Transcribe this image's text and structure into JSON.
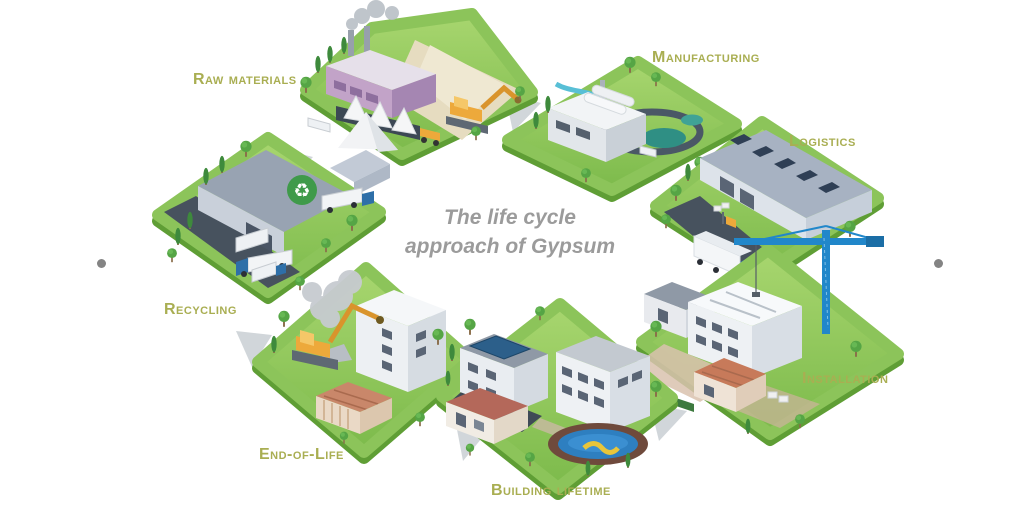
{
  "title": {
    "line1": "The life cycle",
    "line2": "approach of Gypsum"
  },
  "stages": [
    {
      "id": "raw-materials",
      "label": "Raw materials"
    },
    {
      "id": "manufacturing",
      "label": "Manufacturing"
    },
    {
      "id": "logistics",
      "label": "Logistics"
    },
    {
      "id": "installation",
      "label": "Installation"
    },
    {
      "id": "building-lifetime",
      "label": "Building lifetime"
    },
    {
      "id": "end-of-life",
      "label": "End-of-Life"
    },
    {
      "id": "recycling",
      "label": "Recycling"
    }
  ],
  "icons": {
    "recycle": "♻"
  },
  "colors": {
    "label_olive": "#a9ae52",
    "title_gray": "#9b9b9b",
    "grass": "#8cc45a",
    "grass_edge": "#5f9e35",
    "arrow_gray": "#ccd1d6",
    "crane_blue": "#2187ca",
    "excavator_yellow": "#eda93b",
    "recycle_green": "#3f9a4a"
  }
}
